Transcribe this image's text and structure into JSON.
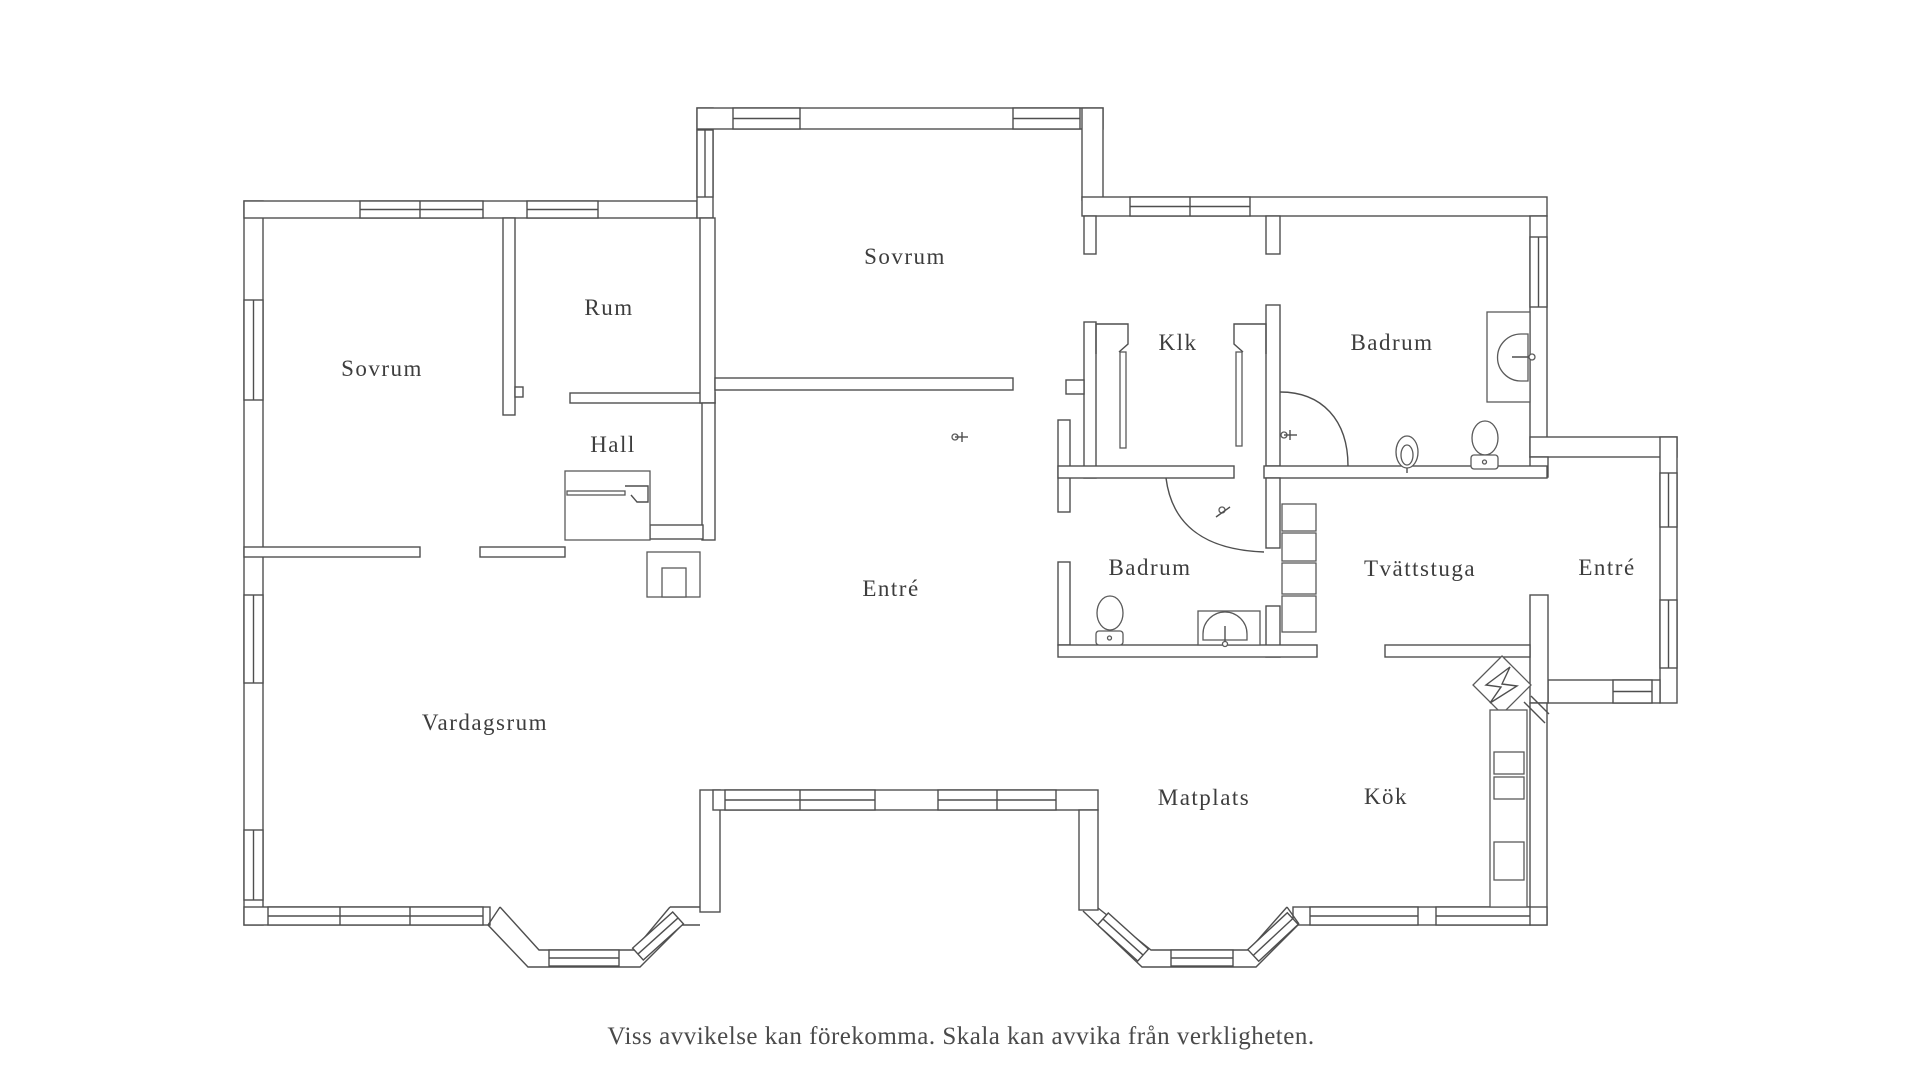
{
  "rooms": [
    {
      "label": "Sovrum"
    },
    {
      "label": "Rum"
    },
    {
      "label": "Sovrum"
    },
    {
      "label": "Klk"
    },
    {
      "label": "Badrum"
    },
    {
      "label": "Hall"
    },
    {
      "label": "Entré"
    },
    {
      "label": "Badrum"
    },
    {
      "label": "Tvättstuga"
    },
    {
      "label": "Entré"
    },
    {
      "label": "Vardagsrum"
    },
    {
      "label": "Matplats"
    },
    {
      "label": "Kök"
    }
  ],
  "disclaimer": "Viss avvikelse kan förekomma. Skala kan avvika från verkligheten.",
  "fixtures": [
    "toilet",
    "toilet",
    "sink",
    "sink",
    "shower",
    "shower",
    "washing-machines",
    "stove",
    "floor-drain",
    "wardrobe",
    "chimney",
    "sliding-doors"
  ],
  "colors": {
    "wall": "#4f4f4f",
    "text": "#3d3d3d",
    "background": "#ffffff"
  }
}
